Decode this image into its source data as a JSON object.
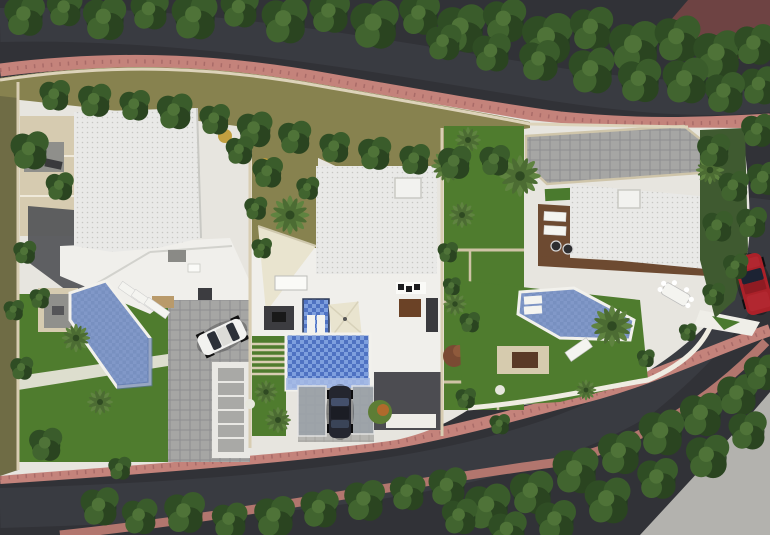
{
  "scene": {
    "kind": "aerial-3d-render-site-plan",
    "buildings_count": 3,
    "swimming_pools_count": 3,
    "cars_visible": [
      "white",
      "dark-gray",
      "red"
    ],
    "features": [
      "asphalt-perimeter-road",
      "salmon-sidewalks",
      "street-tree-rows",
      "palm-trees",
      "lawns",
      "wood-deck",
      "paver-driveways",
      "shade-sail",
      "sun-loungers",
      "outdoor-dining"
    ]
  },
  "colors": {
    "asphalt": "#313237",
    "asphalt_light": "#3c3d43",
    "sidewalk_pink": "#c4837b",
    "sidewalk_pink_far": "#b2766e",
    "sidewalk_dash": "#8e5355",
    "outer_maroon": "#6e4343",
    "site_base": "#e7e5df",
    "olive_ground": "#87824f",
    "olive_dark": "#6f6c45",
    "lawn": "#4f7c2e",
    "wall_beige": "#d8cdb2",
    "patio_beige": "#d6cbb0",
    "roof_white": "#e9e9e7",
    "terrace_white": "#f0efeb",
    "paver_gray": "#a6a6a4",
    "paver_pale": "#b7b6b2",
    "shadow_gray": "#56575b",
    "garage_dark": "#4c4c51",
    "pool_mute": "#8198c8",
    "pool_bright": "#4f72c2",
    "pool_steps": "#a9bde6",
    "deck_wood": "#6d4a31",
    "umbrella_cream": "#e9e4cf",
    "concrete": "#b3b2ae",
    "car_white": "#f2f2f0",
    "car_dark": "#24262f",
    "car_red": "#ab2129"
  },
  "vegetation": {
    "trees": [
      [
        25,
        15,
        1.6
      ],
      [
        65,
        8,
        1.4
      ],
      [
        105,
        18,
        1.7
      ],
      [
        150,
        10,
        1.5
      ],
      [
        195,
        16,
        1.8
      ],
      [
        240,
        8,
        1.5
      ],
      [
        285,
        20,
        1.8
      ],
      [
        330,
        12,
        1.6
      ],
      [
        375,
        24,
        1.9
      ],
      [
        420,
        14,
        1.6
      ],
      [
        462,
        28,
        1.9
      ],
      [
        505,
        20,
        1.7
      ],
      [
        548,
        38,
        2.0
      ],
      [
        592,
        28,
        1.7
      ],
      [
        635,
        46,
        2.0
      ],
      [
        678,
        38,
        1.8
      ],
      [
        718,
        54,
        1.9
      ],
      [
        755,
        44,
        1.6
      ],
      [
        760,
        85,
        1.5
      ],
      [
        725,
        92,
        1.6
      ],
      [
        686,
        80,
        1.8
      ],
      [
        640,
        80,
        1.7
      ],
      [
        592,
        70,
        1.8
      ],
      [
        540,
        60,
        1.6
      ],
      [
        492,
        52,
        1.5
      ],
      [
        444,
        42,
        1.4
      ],
      [
        758,
        130,
        1.3
      ],
      [
        764,
        178,
        1.3
      ],
      [
        752,
        222,
        1.2
      ],
      [
        55,
        95,
        1.2
      ],
      [
        95,
        100,
        1.3
      ],
      [
        135,
        105,
        1.2
      ],
      [
        175,
        111,
        1.4
      ],
      [
        215,
        119,
        1.2
      ],
      [
        255,
        129,
        1.4
      ],
      [
        295,
        137,
        1.3
      ],
      [
        335,
        147,
        1.2
      ],
      [
        375,
        153,
        1.3
      ],
      [
        415,
        159,
        1.2
      ],
      [
        455,
        162,
        1.3
      ],
      [
        495,
        160,
        1.2
      ],
      [
        30,
        150,
        1.5
      ],
      [
        60,
        186,
        1.1
      ],
      [
        25,
        252,
        0.9
      ],
      [
        14,
        310,
        0.8
      ],
      [
        22,
        368,
        0.9
      ],
      [
        46,
        444,
        1.3
      ],
      [
        120,
        468,
        0.9
      ],
      [
        40,
        298,
        0.8
      ],
      [
        240,
        150,
        1.1
      ],
      [
        268,
        172,
        1.2
      ],
      [
        256,
        208,
        0.9
      ],
      [
        308,
        188,
        0.9
      ],
      [
        262,
        248,
        0.8
      ],
      [
        448,
        252,
        0.8
      ],
      [
        470,
        322,
        0.8
      ],
      [
        466,
        398,
        0.8
      ],
      [
        500,
        424,
        0.8
      ],
      [
        452,
        286,
        0.7
      ],
      [
        714,
        150,
        1.3
      ],
      [
        734,
        186,
        1.2
      ],
      [
        718,
        226,
        1.2
      ],
      [
        736,
        266,
        1.0
      ],
      [
        714,
        294,
        0.9
      ],
      [
        646,
        358,
        0.7
      ],
      [
        688,
        332,
        0.7
      ],
      [
        100,
        506,
        1.5
      ],
      [
        140,
        516,
        1.4
      ],
      [
        185,
        512,
        1.6
      ],
      [
        230,
        520,
        1.4
      ],
      [
        275,
        516,
        1.6
      ],
      [
        320,
        508,
        1.5
      ],
      [
        365,
        500,
        1.6
      ],
      [
        408,
        492,
        1.4
      ],
      [
        448,
        486,
        1.5
      ],
      [
        488,
        506,
        1.8
      ],
      [
        532,
        492,
        1.7
      ],
      [
        576,
        470,
        1.8
      ],
      [
        620,
        452,
        1.7
      ],
      [
        662,
        432,
        1.8
      ],
      [
        702,
        414,
        1.7
      ],
      [
        738,
        394,
        1.6
      ],
      [
        762,
        372,
        1.4
      ],
      [
        608,
        500,
        1.8
      ],
      [
        658,
        478,
        1.6
      ],
      [
        708,
        456,
        1.7
      ],
      [
        748,
        430,
        1.5
      ],
      [
        556,
        520,
        1.6
      ],
      [
        508,
        530,
        1.5
      ],
      [
        460,
        516,
        1.4
      ]
    ],
    "palms": [
      [
        290,
        215,
        1.5
      ],
      [
        448,
        166,
        1.3
      ],
      [
        462,
        215,
        1.0
      ],
      [
        520,
        176,
        1.6
      ],
      [
        266,
        392,
        0.9
      ],
      [
        278,
        420,
        1.0
      ],
      [
        76,
        338,
        1.1
      ],
      [
        100,
        402,
        1.0
      ],
      [
        612,
        326,
        1.6
      ],
      [
        710,
        170,
        1.1
      ],
      [
        468,
        140,
        1.0
      ],
      [
        455,
        304,
        0.9
      ],
      [
        586,
        390,
        0.8
      ]
    ]
  }
}
